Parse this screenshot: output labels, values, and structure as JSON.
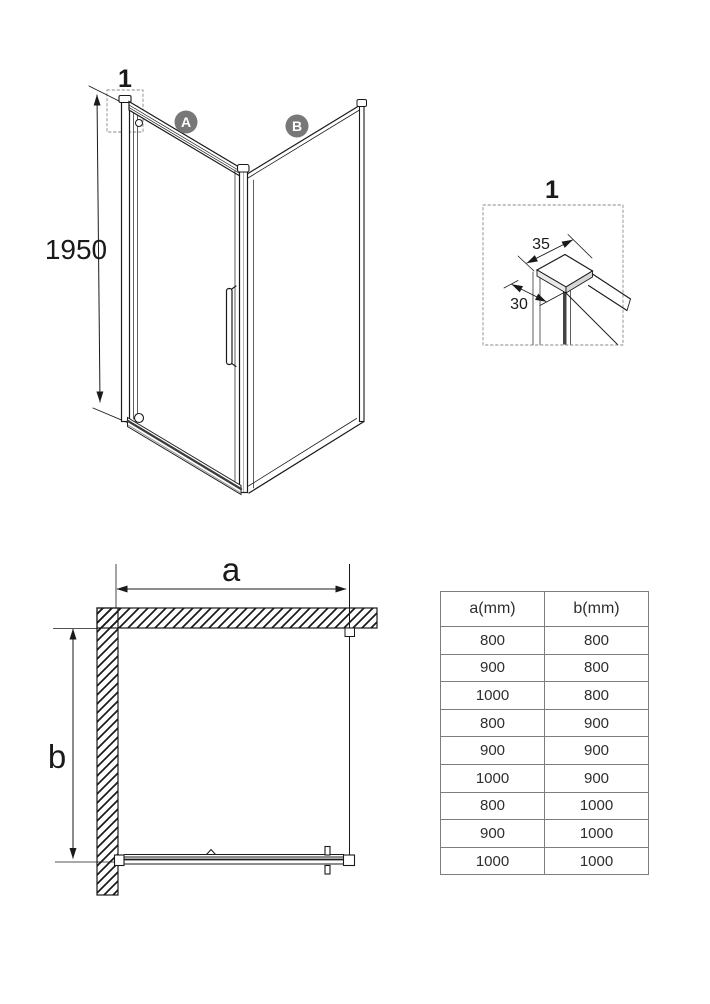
{
  "iso_view": {
    "callout_label": "1",
    "height_dim": "1950",
    "panel_a_label": "A",
    "panel_b_label": "B"
  },
  "detail_view": {
    "callout_label": "1",
    "top_width_dim": "35",
    "side_depth_dim": "30"
  },
  "plan_view": {
    "width_label": "a",
    "depth_label": "b"
  },
  "size_table": {
    "headers": [
      "a(mm)",
      "b(mm)"
    ],
    "rows": [
      [
        "800",
        "800"
      ],
      [
        "900",
        "800"
      ],
      [
        "1000",
        "800"
      ],
      [
        "800",
        "900"
      ],
      [
        "900",
        "900"
      ],
      [
        "1000",
        "900"
      ],
      [
        "800",
        "1000"
      ],
      [
        "900",
        "1000"
      ],
      [
        "1000",
        "1000"
      ]
    ]
  },
  "colors": {
    "line": "#1a1a1a",
    "badge_gray": "#787878",
    "badge_text": "#ffffff",
    "dashed_box": "#8a8a8a",
    "table_border": "#7d7d7d",
    "dark_rail": "#3d3d3d"
  }
}
